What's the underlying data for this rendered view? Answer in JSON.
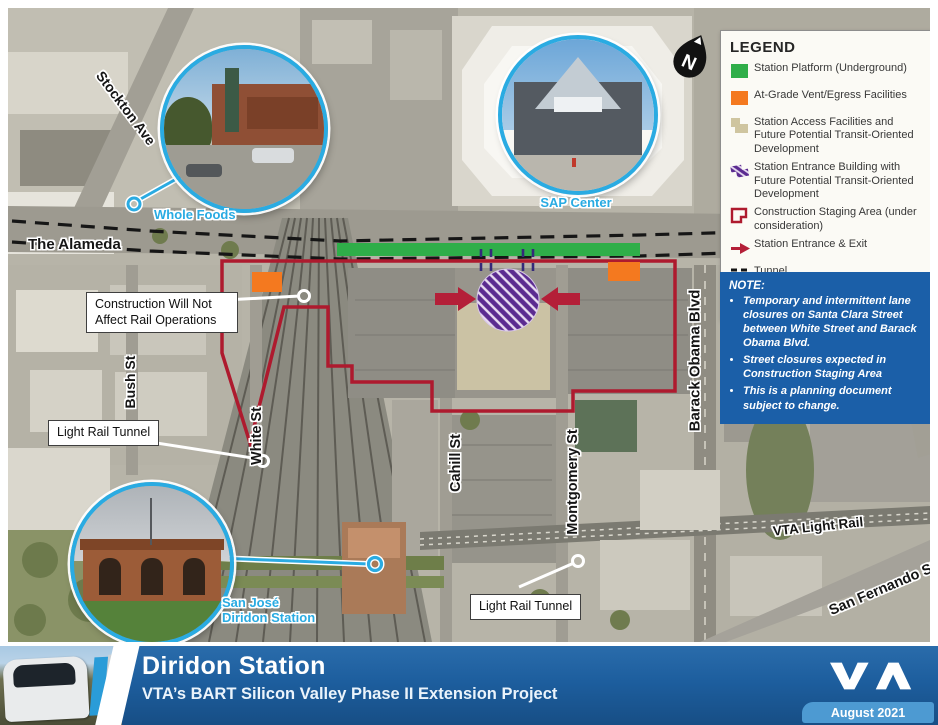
{
  "map": {
    "street_labels": [
      {
        "text": "Stockton Ave"
      },
      {
        "text": "The Alameda"
      },
      {
        "text": "Bush St"
      },
      {
        "text": "White St"
      },
      {
        "text": "Cahill St"
      },
      {
        "text": "Montgomery St"
      },
      {
        "text": "Barack Obama Blvd"
      },
      {
        "text": "Delmas Ave"
      },
      {
        "text": "VTA Light Rail"
      },
      {
        "text": "San Fernando St"
      }
    ],
    "callouts": [
      {
        "text": "Construction Will Not Affect Rail Operations"
      },
      {
        "text": "Light Rail Tunnel"
      },
      {
        "text": "Light Rail Tunnel"
      }
    ],
    "insets": [
      {
        "label": "Whole Foods"
      },
      {
        "label": "SAP Center"
      },
      {
        "label_line1": "San José",
        "label_line2": "Diridon Station"
      }
    ],
    "north_label": "N"
  },
  "legend": {
    "title": "LEGEND",
    "items": [
      {
        "label": "Station Platform (Underground)",
        "color": "#2fae49"
      },
      {
        "label": "At-Grade Vent/Egress Facilities",
        "color": "#f4791f"
      },
      {
        "label": "Station Access Facilities and Future Potential Transit-Oriented Development",
        "color": "#cfc5a0"
      },
      {
        "label": "Station Entrance Building with Future Potential Transit-Oriented Development",
        "color": "#5b2b90"
      },
      {
        "label": "Construction Staging Area (under consideration)",
        "color": "#ae1a2e"
      },
      {
        "label": "Station Entrance & Exit",
        "color": "#ae1a2e"
      },
      {
        "label": "Tunnel",
        "color": "#141414"
      },
      {
        "label": "Adits",
        "color": "#5b2b90"
      }
    ]
  },
  "note": {
    "title": "NOTE:",
    "bullets": [
      "Temporary and intermittent lane closures on Santa Clara Street between White Street and Barack Obama Blvd.",
      "Street closures expected in Construction Staging Area",
      "This is a planning document subject to change."
    ],
    "bg": "#1b5fa8"
  },
  "footer": {
    "title": "Diridon Station",
    "subtitle": "VTA’s BART Silicon Valley Phase II Extension Project",
    "logo": "VTA",
    "date_badge": "August 2021"
  }
}
